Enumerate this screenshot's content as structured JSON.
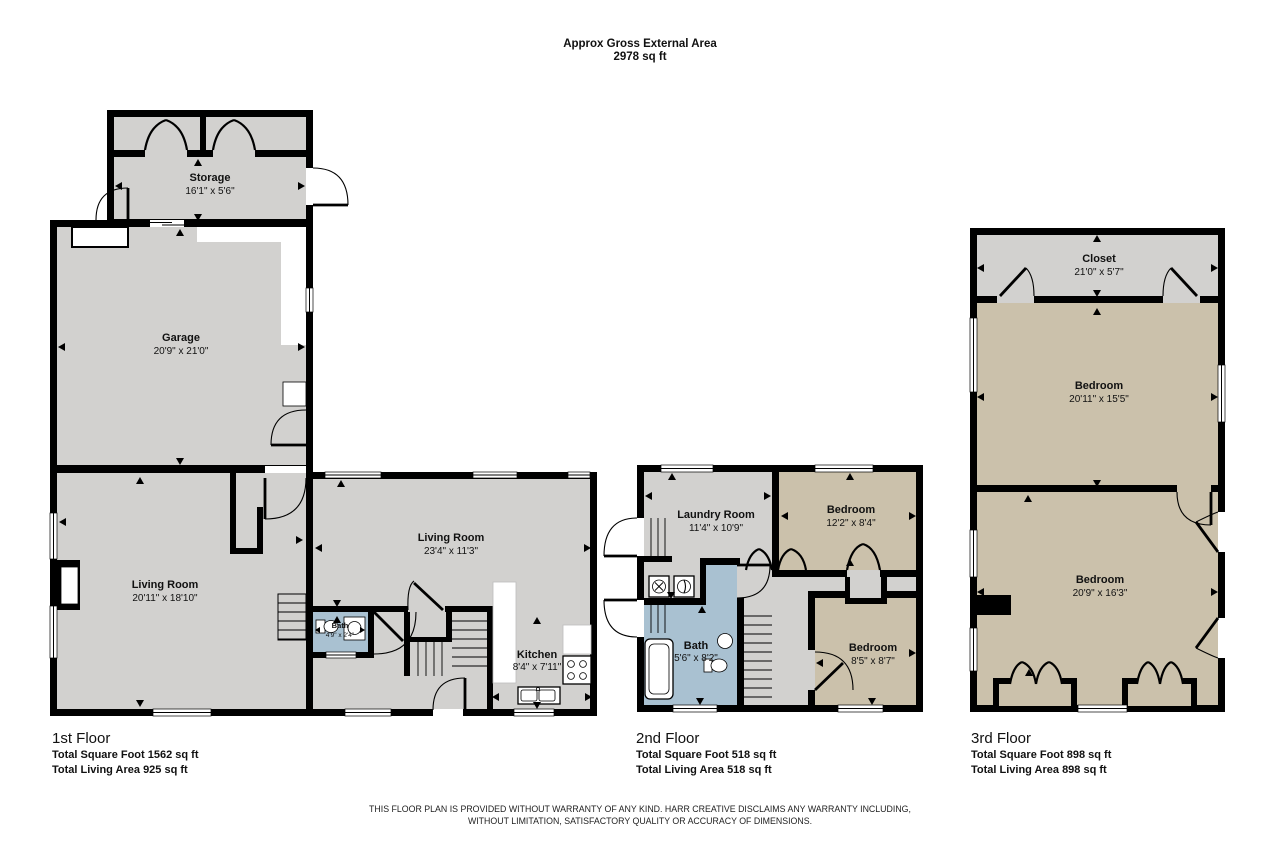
{
  "header": {
    "line1": "Approx Gross External Area",
    "line2": "2978 sq ft"
  },
  "colors": {
    "wall": "#000000",
    "room_gray": "#d2d1cf",
    "room_tan": "#cbc1ab",
    "room_blue": "#a9c1d1",
    "background": "#ffffff"
  },
  "floors": [
    {
      "title": "1st Floor",
      "square": "Total Square Foot 1562 sq ft",
      "living": "Total Living Area 925 sq ft",
      "rooms": [
        {
          "name": "Storage",
          "dims": "16'1\" x 5'6\""
        },
        {
          "name": "Garage",
          "dims": "20'9\" x 21'0\""
        },
        {
          "name": "Living Room",
          "dims": "20'11\" x 18'10\""
        },
        {
          "name": "Living Room",
          "dims": "23'4\" x 11'3\""
        },
        {
          "name": "Bath",
          "dims": "4'9\" x 2'4\""
        },
        {
          "name": "Kitchen",
          "dims": "8'4\" x 7'11\""
        }
      ]
    },
    {
      "title": "2nd Floor",
      "square": "Total Square Foot 518 sq ft",
      "living": "Total Living Area 518 sq ft",
      "rooms": [
        {
          "name": "Laundry Room",
          "dims": "11'4\" x 10'9\""
        },
        {
          "name": "Bedroom",
          "dims": "12'2\" x 8'4\""
        },
        {
          "name": "Bath",
          "dims": "5'6\" x 8'2\""
        },
        {
          "name": "Bedroom",
          "dims": "8'5\" x 8'7\""
        }
      ]
    },
    {
      "title": "3rd Floor",
      "square": "Total Square Foot 898 sq ft",
      "living": "Total Living Area 898 sq ft",
      "rooms": [
        {
          "name": "Closet",
          "dims": "21'0\" x 5'7\""
        },
        {
          "name": "Bedroom",
          "dims": "20'11\" x 15'5\""
        },
        {
          "name": "Bedroom",
          "dims": "20'9\" x 16'3\""
        }
      ]
    }
  ],
  "disclaimer": {
    "line1": "THIS FLOOR PLAN IS PROVIDED WITHOUT WARRANTY OF ANY KIND. HARR CREATIVE DISCLAIMS ANY WARRANTY INCLUDING,",
    "line2": "WITHOUT LIMITATION, SATISFACTORY QUALITY OR ACCURACY OF DIMENSIONS."
  }
}
